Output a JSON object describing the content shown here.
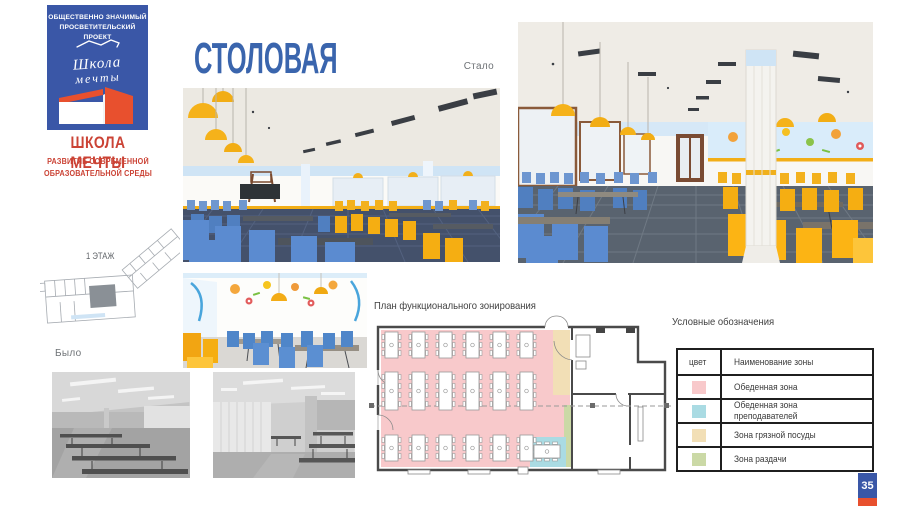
{
  "slide": {
    "background": "#ffffff"
  },
  "logo": {
    "program_line1": "ОБЩЕСТВЕННО ЗНАЧИМЫЙ",
    "program_line2": "ПРОСВЕТИТЕЛЬСКИЙ ПРОЕКТ",
    "script_word1": "Школа",
    "script_word2": "мечты",
    "name": "ШКОЛА МЕЧТЫ",
    "tagline_line1": "РАЗВИТИЕ СОВРЕМЕННОЙ",
    "tagline_line2": "ОБРАЗОВАТЕЛЬНОЙ СРЕДЫ",
    "box_color": "#3a57a7",
    "text_red": "#cb4335"
  },
  "header": {
    "title": "СТОЛОВАЯ",
    "color": "#3a65ad"
  },
  "floor_plan_sketch": {
    "label": "1 ЭТАЖ"
  },
  "before": {
    "label": "Было"
  },
  "after": {
    "label": "Стало"
  },
  "zoning_plan": {
    "label": "План функционального зонирования",
    "zones": {
      "dining": "#f8c9cb",
      "teachers": "#aadbe3",
      "dirty_dishes": "#f2dfb6",
      "serving": "#cbd9a6"
    }
  },
  "legend": {
    "heading": "Условные обозначения",
    "columns": {
      "color": "цвет",
      "zone_name": "Наименование зоны"
    },
    "rows": [
      {
        "name": "Обеденная зона",
        "color": "#f8c9cb"
      },
      {
        "name": "Обеденная зона преподавателей",
        "color": "#aadbe3"
      },
      {
        "name": "Зона грязной посуды",
        "color": "#f2dfb6"
      },
      {
        "name": "Зона раздачи",
        "color": "#cbd9a6"
      }
    ]
  },
  "page_badge": {
    "number": "35",
    "top_color": "#3a57a7",
    "bottom_color": "#e8502e"
  },
  "render_colors": {
    "chair_blue": "#5586c8",
    "chair_yellow": "#f5b21a",
    "wall_band_blue": "#cfe4f5",
    "floor_dark": "#4a5670",
    "stripe_yellow": "#f2ae17"
  }
}
